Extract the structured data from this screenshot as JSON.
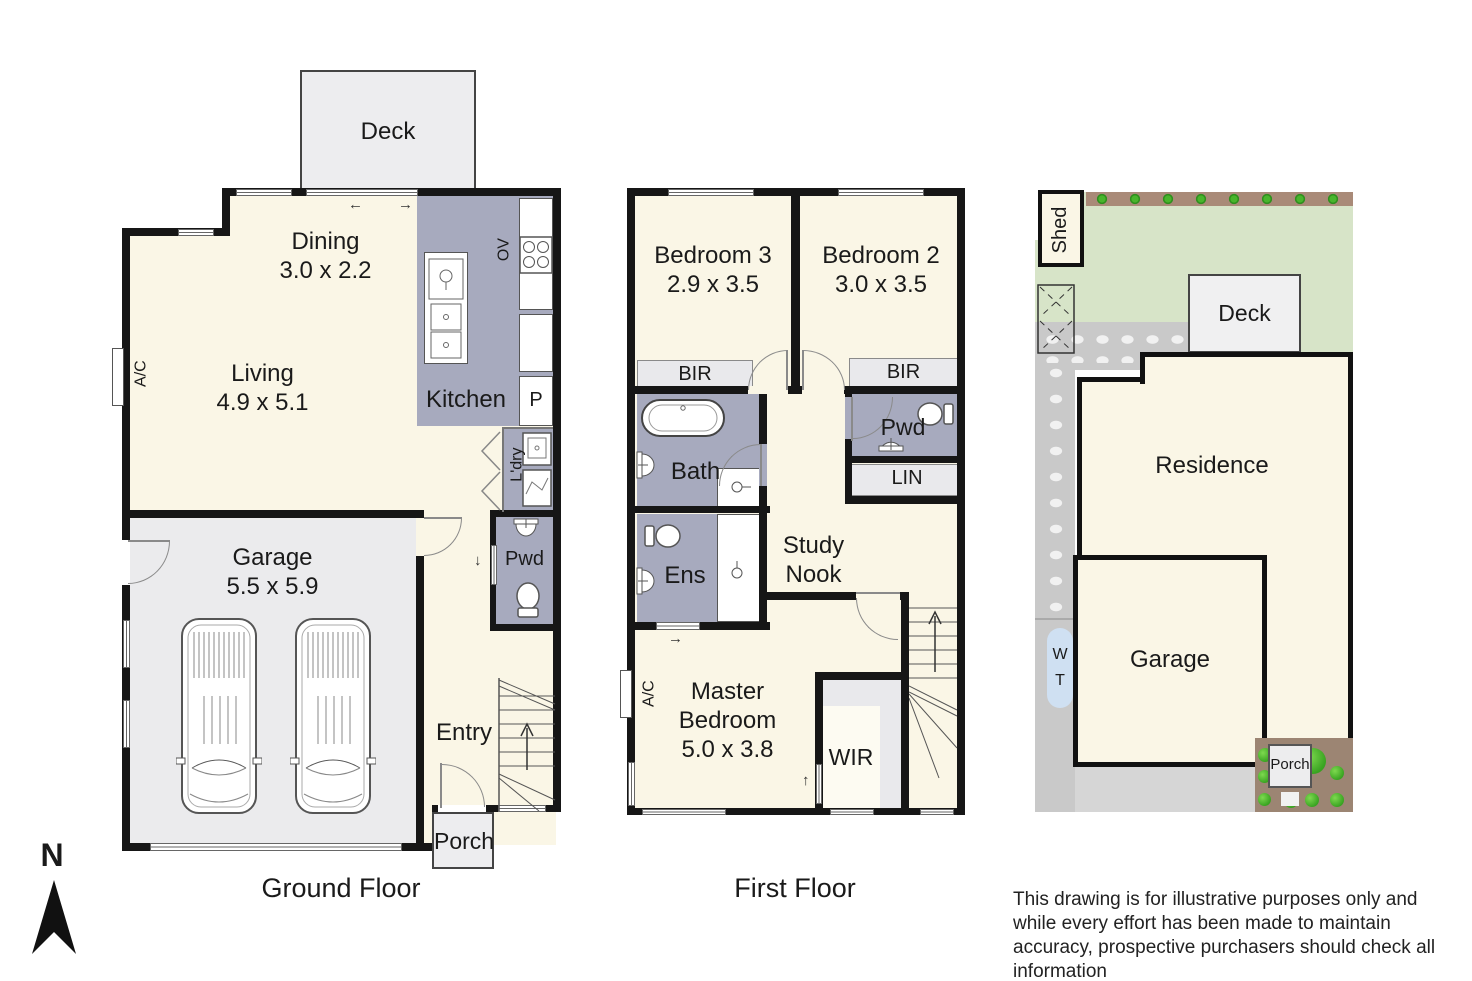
{
  "colors": {
    "wall": "#161616",
    "floor_cream": "#faf6e6",
    "wet_gray": "#a7aabe",
    "light_gray": "#ebebed",
    "lawn_green": "#d7e4c8",
    "hedge_brown": "#a98a78",
    "bush_green": "#3aa422",
    "driveway_gray": "#c9c9c9",
    "tank_blue": "#cfe0f2",
    "dirt_brown": "#9c8573"
  },
  "compass": {
    "label": "N"
  },
  "icons": {
    "arrow_left": "←",
    "arrow_right": "→",
    "arrow_up": "↑",
    "arrow_down": "↓"
  },
  "ground_floor": {
    "title": "Ground Floor",
    "deck": "Deck",
    "dining": {
      "name": "Dining",
      "dims": "3.0 x 2.2"
    },
    "living": {
      "name": "Living",
      "dims": "4.9 x 5.1"
    },
    "kitchen": "Kitchen",
    "oven": "OV",
    "pantry": "P",
    "laundry": "L'dry",
    "powder": "Pwd",
    "ac": "A/C",
    "garage": {
      "name": "Garage",
      "dims": "5.5 x 5.9"
    },
    "entry": "Entry",
    "porch": "Porch"
  },
  "first_floor": {
    "title": "First Floor",
    "bedroom3": {
      "name": "Bedroom 3",
      "dims": "2.9 x 3.5"
    },
    "bedroom2": {
      "name": "Bedroom 2",
      "dims": "3.0 x 3.5"
    },
    "bir_left": "BIR",
    "bir_right": "BIR",
    "powder": "Pwd",
    "linen": "LIN",
    "bath": "Bath",
    "ensuite": "Ens",
    "study_nook": "Study Nook",
    "master": {
      "name": "Master Bedroom",
      "dims": "5.0 x 3.8"
    },
    "wir": "WIR",
    "ac": "A/C"
  },
  "site_plan": {
    "shed": "Shed",
    "deck": "Deck",
    "residence": "Residence",
    "garage": "Garage",
    "porch": "Porch",
    "water_tank": "W T"
  },
  "disclaimer": "This drawing is for illustrative purposes only and while every effort has been made to maintain accuracy, prospective purchasers should check all information"
}
